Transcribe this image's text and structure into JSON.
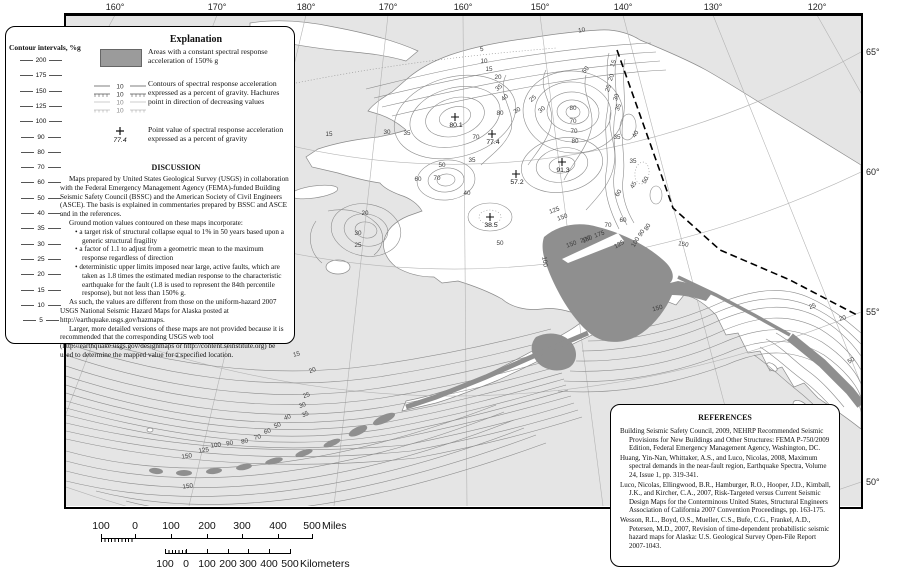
{
  "colors": {
    "sea": "#e5e5e5",
    "land": "#ffffff",
    "high_area": "#8f8f8f",
    "contour": "#8c8c8c",
    "graticule": "#b4b4b4",
    "frame": "#000000"
  },
  "axis": {
    "top": [
      {
        "t": "160°",
        "x": 49
      },
      {
        "t": "170°",
        "x": 151
      },
      {
        "t": "180°",
        "x": 240
      },
      {
        "t": "170°",
        "x": 322
      },
      {
        "t": "160°",
        "x": 397
      },
      {
        "t": "150°",
        "x": 474
      },
      {
        "t": "140°",
        "x": 557
      },
      {
        "t": "130°",
        "x": 647
      },
      {
        "t": "120°",
        "x": 751
      }
    ],
    "right": [
      {
        "t": "65°",
        "y": 37
      },
      {
        "t": "60°",
        "y": 157
      },
      {
        "t": "55°",
        "y": 297
      },
      {
        "t": "50°",
        "y": 467
      }
    ]
  },
  "map": {
    "point_values": [
      {
        "v": "80.1",
        "x": 389,
        "y": 102
      },
      {
        "v": "77.4",
        "x": 426,
        "y": 119
      },
      {
        "v": "91.3",
        "x": 496,
        "y": 147
      },
      {
        "v": "57.2",
        "x": 450,
        "y": 159
      },
      {
        "v": "38.5",
        "x": 424,
        "y": 202
      }
    ],
    "contour_labels": [
      {
        "t": "5",
        "x": 416,
        "y": 36,
        "r": -8
      },
      {
        "t": "10",
        "x": 418,
        "y": 48
      },
      {
        "t": "15",
        "x": 423,
        "y": 56
      },
      {
        "t": "20",
        "x": 432,
        "y": 64
      },
      {
        "t": "35",
        "x": 434,
        "y": 74,
        "r": -40
      },
      {
        "t": "40",
        "x": 440,
        "y": 84,
        "r": -40
      },
      {
        "t": "25",
        "x": 468,
        "y": 85,
        "r": -40
      },
      {
        "t": "30",
        "x": 477,
        "y": 96,
        "r": -40
      },
      {
        "t": "10",
        "x": 516,
        "y": 17,
        "r": -10
      },
      {
        "t": "50",
        "x": 521,
        "y": 56,
        "r": -50
      },
      {
        "t": "80",
        "x": 507,
        "y": 95
      },
      {
        "t": "70",
        "x": 507,
        "y": 108
      },
      {
        "t": "70",
        "x": 508,
        "y": 118
      },
      {
        "t": "80",
        "x": 509,
        "y": 128
      },
      {
        "t": "80",
        "x": 434,
        "y": 100
      },
      {
        "t": "70",
        "x": 410,
        "y": 124
      },
      {
        "t": "30",
        "x": 452,
        "y": 97,
        "r": -30
      },
      {
        "t": "30",
        "x": 321,
        "y": 119
      },
      {
        "t": "35",
        "x": 341,
        "y": 120
      },
      {
        "t": "15",
        "x": 263,
        "y": 121
      },
      {
        "t": "35",
        "x": 406,
        "y": 147
      },
      {
        "t": "50",
        "x": 376,
        "y": 152
      },
      {
        "t": "60",
        "x": 352,
        "y": 166
      },
      {
        "t": "70",
        "x": 371,
        "y": 165
      },
      {
        "t": "40",
        "x": 401,
        "y": 180
      },
      {
        "t": "20",
        "x": 299,
        "y": 200
      },
      {
        "t": "30",
        "x": 292,
        "y": 220
      },
      {
        "t": "25",
        "x": 292,
        "y": 232
      },
      {
        "t": "50",
        "x": 434,
        "y": 230
      },
      {
        "t": "125",
        "x": 489,
        "y": 197,
        "r": -20
      },
      {
        "t": "150",
        "x": 497,
        "y": 204,
        "r": -20
      },
      {
        "t": "100",
        "x": 477,
        "y": 247,
        "r": 80
      },
      {
        "t": "150",
        "x": 522,
        "y": 226,
        "r": -25
      },
      {
        "t": "150",
        "x": 506,
        "y": 231,
        "r": -20
      },
      {
        "t": "200",
        "x": 520,
        "y": 226,
        "r": -20
      },
      {
        "t": "175",
        "x": 534,
        "y": 221,
        "r": -20
      },
      {
        "t": "70",
        "x": 542,
        "y": 212
      },
      {
        "t": "60",
        "x": 557,
        "y": 207
      },
      {
        "t": "125",
        "x": 554,
        "y": 231,
        "r": -30
      },
      {
        "t": "100",
        "x": 571,
        "y": 228,
        "r": -60
      },
      {
        "t": "90",
        "x": 577,
        "y": 219,
        "r": -60
      },
      {
        "t": "80",
        "x": 583,
        "y": 213,
        "r": -60
      },
      {
        "t": "150",
        "x": 617,
        "y": 231,
        "r": 10
      },
      {
        "t": "150",
        "x": 592,
        "y": 295,
        "r": -15
      },
      {
        "t": "15",
        "x": 231,
        "y": 341,
        "r": -15
      },
      {
        "t": "20",
        "x": 247,
        "y": 357,
        "r": -20
      },
      {
        "t": "25",
        "x": 241,
        "y": 382,
        "r": -20
      },
      {
        "t": "30",
        "x": 237,
        "y": 392,
        "r": -20
      },
      {
        "t": "35",
        "x": 240,
        "y": 401,
        "r": -25
      },
      {
        "t": "40",
        "x": 222,
        "y": 404,
        "r": -20
      },
      {
        "t": "50",
        "x": 212,
        "y": 412,
        "r": -20
      },
      {
        "t": "60",
        "x": 202,
        "y": 418,
        "r": -18
      },
      {
        "t": "70",
        "x": 192,
        "y": 424,
        "r": -15
      },
      {
        "t": "80",
        "x": 179,
        "y": 428,
        "r": -12
      },
      {
        "t": "90",
        "x": 164,
        "y": 430,
        "r": -10
      },
      {
        "t": "100",
        "x": 150,
        "y": 432,
        "r": -8
      },
      {
        "t": "125",
        "x": 138,
        "y": 437,
        "r": -8
      },
      {
        "t": "150",
        "x": 121,
        "y": 443,
        "r": -8
      },
      {
        "t": "150",
        "x": 122,
        "y": 473,
        "r": -8
      },
      {
        "t": "15",
        "x": 549,
        "y": 49,
        "r": -70
      },
      {
        "t": "20",
        "x": 547,
        "y": 63,
        "r": -70
      },
      {
        "t": "25",
        "x": 544,
        "y": 74,
        "r": -70
      },
      {
        "t": "30",
        "x": 552,
        "y": 83,
        "r": -70
      },
      {
        "t": "35",
        "x": 554,
        "y": 93,
        "r": -70
      },
      {
        "t": "40",
        "x": 571,
        "y": 120,
        "r": -60
      },
      {
        "t": "35",
        "x": 551,
        "y": 124
      },
      {
        "t": "35",
        "x": 567,
        "y": 148
      },
      {
        "t": "45",
        "x": 569,
        "y": 171,
        "r": -60
      },
      {
        "t": "50",
        "x": 581,
        "y": 166,
        "r": -60
      },
      {
        "t": "60",
        "x": 554,
        "y": 179,
        "r": -60
      },
      {
        "t": "25",
        "x": 747,
        "y": 293,
        "r": -20
      },
      {
        "t": "20",
        "x": 777,
        "y": 305,
        "r": -15
      },
      {
        "t": "50",
        "x": 786,
        "y": 347,
        "r": -30
      }
    ]
  },
  "contour_scale": {
    "title": "Contour intervals, %g",
    "values": [
      "200",
      "175",
      "150",
      "125",
      "100",
      "90",
      "80",
      "70",
      "60",
      "50",
      "40",
      "35",
      "30",
      "25",
      "20",
      "15",
      "10",
      "5"
    ]
  },
  "explanation": {
    "title": "Explanation",
    "items": [
      {
        "text": "Areas with a constant spectral response acceleration of 150% g"
      },
      {
        "text": "Contours of spectral response acceleration expressed as a percent of gravity.  Hachures point in direction of decreasing values"
      },
      {
        "text": "Point value of spectral response acceleration expressed as a percent of gravity"
      }
    ],
    "contour_symbol_values": [
      "10",
      "10",
      "10",
      "10"
    ],
    "point_example": "77.4",
    "discussion_title": "DISCUSSION",
    "p1": "Maps prepared by United States Geological Survey (USGS) in collaboration with the Federal Emergency Management Agency (FEMA)-funded Building Seismic Safety Council (BSSC) and the American Society of Civil Engineers (ASCE).  The basis is explained in commentaries prepared by BSSC and ASCE and in the references.",
    "p2": "Ground motion values contoured on these maps incorporate:",
    "bullets": [
      "a target risk of structural collapse equal to 1% in 50 years based upon a generic structural fragility",
      "a factor of 1.1 to adjust from a geometric mean to the maximum response regardless of direction",
      "deterministic upper limits imposed near large, active faults, which are taken as 1.8 times the estimated median response to the characteristic earthquake for the fault (1.8 is used to represent  the 84th percentile response), but not less than 150% g."
    ],
    "p3": "As such, the values are different from those on the uniform-hazard 2007 USGS National Seismic Hazard Maps for Alaska posted at http://earthquake.usgs.gov/hazmaps.",
    "p4": "Larger, more detailed versions of these maps are not provided because it is recommended that the corresponding USGS web tool (http://earthquake.usgs.gov/designmaps or http://content.seinstitute.org) be used to determine the mapped value for a specified location."
  },
  "references": {
    "title": "REFERENCES",
    "entries": [
      "Building Seismic Safety Council, 2009, NEHRP Recommended Seismic Provisions for New Buildings and Other Structures: FEMA P-750/2009 Edition, Federal Emergency Management Agency, Washington, DC.",
      "Huang, Yin-Nan, Whittaker, A.S., and Luco, Nicolas, 2008, Maximum spectral demands in the near-fault region, Earthquake Spectra, Volume 24, Issue 1, pp. 319-341.",
      "Luco, Nicolas, Ellingwood, B.R., Hamburger, R.O., Hooper, J.D., Kimball, J.K., and Kircher, C.A., 2007, Risk-Targeted versus Current Seismic Design Maps for the Conterminous United States, Structural Engineers Association of California 2007 Convention Proceedings, pp. 163-175.",
      "Wesson, R.L., Boyd, O.S., Mueller, C.S., Bufe, C.G., Frankel, A.D., Petersen, M.D., 2007, Revision of time-dependent probabilistic seismic hazard maps for Alaska: U.S. Geological Survey Open-File Report 2007-1043."
    ]
  },
  "scalebars": {
    "miles": {
      "labels": [
        "100",
        "0",
        "100",
        "200",
        "300",
        "400",
        "500"
      ],
      "unit": "Miles"
    },
    "kilometers": {
      "labels": [
        "100",
        "0",
        "100",
        "200",
        "300",
        "400",
        "500"
      ],
      "unit": "Kilometers"
    }
  }
}
